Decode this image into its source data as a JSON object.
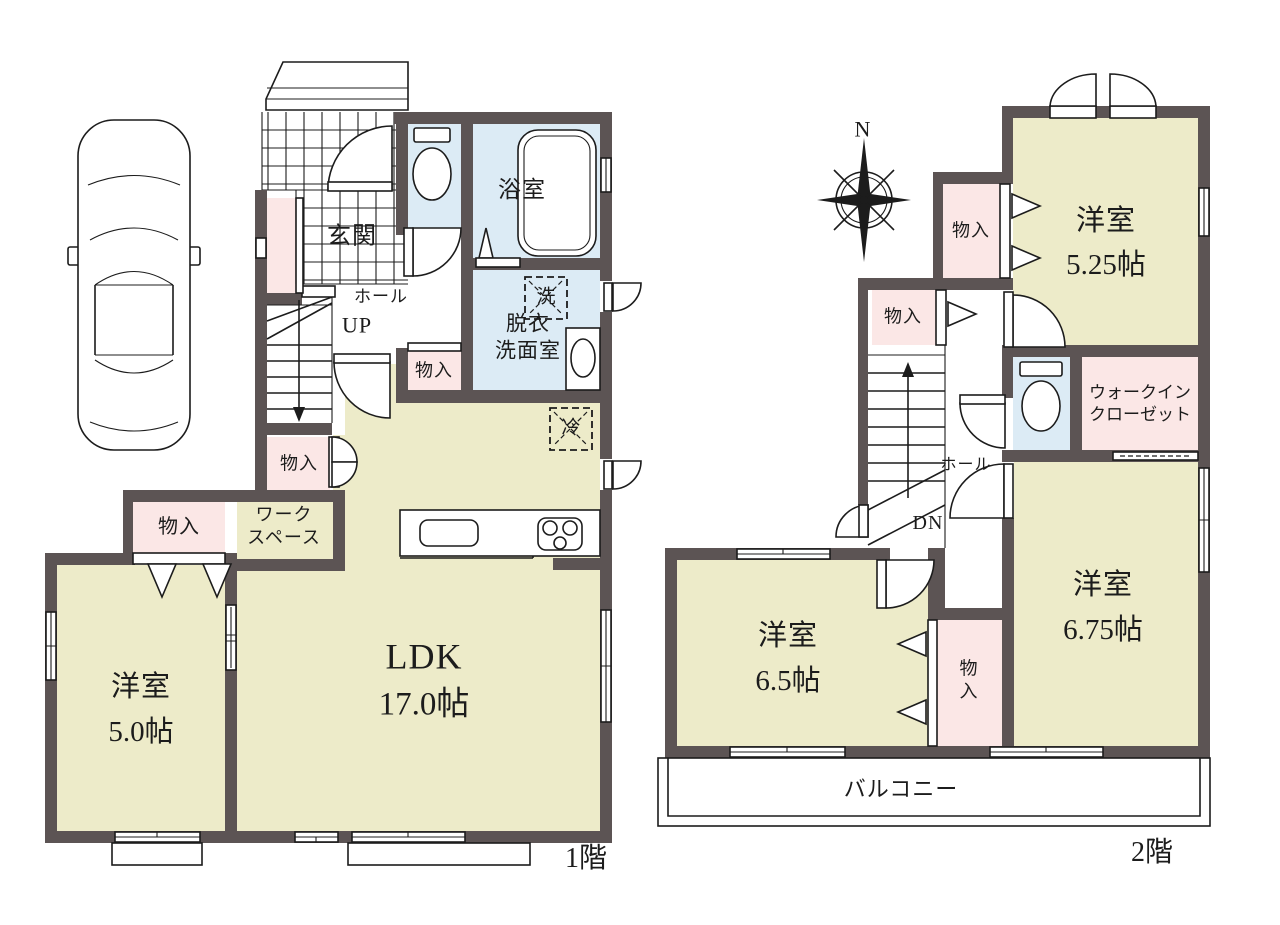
{
  "colors": {
    "wall": "#5c5454",
    "room": "#edebc9",
    "wet": "#dcebf5",
    "storage": "#fbe7e6",
    "line": "#1c1c1c",
    "bg": "#ffffff"
  },
  "floor1": {
    "floor_label": "1階",
    "entrance": "玄関",
    "hall": "ホール",
    "stairs_direction": "UP",
    "bathroom": "浴室",
    "dressing_room": "脱衣\n洗面室",
    "washer_symbol": "洗",
    "fridge_symbol": "冷",
    "storage_by_stairs": "物入",
    "storage_by_hall": "物入",
    "storage_bedroom": "物入",
    "workspace": "ワーク\nスペース",
    "bedroom": {
      "label": "洋室",
      "size": "5.0帖"
    },
    "ldk": {
      "label": "LDK",
      "size": "17.0帖"
    }
  },
  "floor2": {
    "floor_label": "2階",
    "compass_north": "N",
    "storage_1": "物入",
    "storage_2": "物入",
    "storage_3": "物\n入",
    "bedroom_525": {
      "label": "洋室",
      "size": "5.25帖"
    },
    "walk_in_closet": "ウォークイン\nクローゼット",
    "hall": "ホール",
    "stairs_direction": "DN",
    "bedroom_65": {
      "label": "洋室",
      "size": "6.5帖"
    },
    "bedroom_675": {
      "label": "洋室",
      "size": "6.75帖"
    },
    "balcony": "バルコニー"
  }
}
